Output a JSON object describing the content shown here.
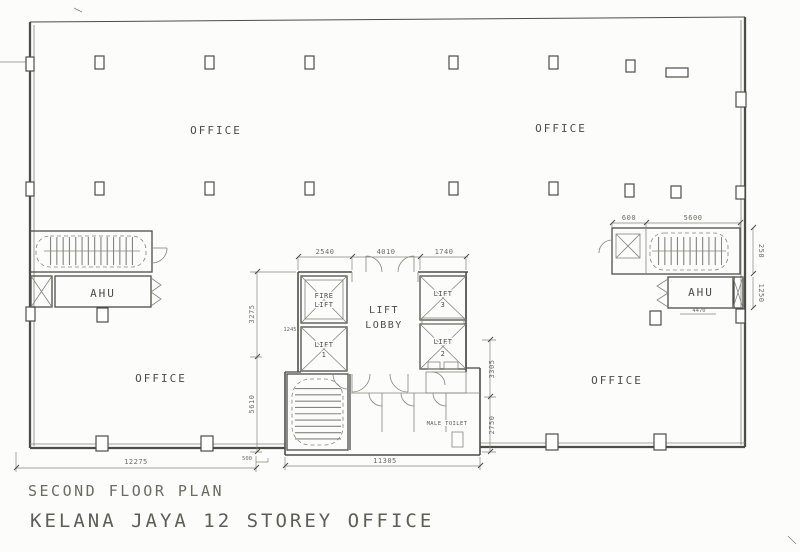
{
  "title_block": {
    "plan_title": "SECOND FLOOR PLAN",
    "project_title": "KELANA JAYA 12 STOREY OFFICE"
  },
  "labels": {
    "office": "OFFICE",
    "ahu": "AHU",
    "lift": "LIFT",
    "lobby": "LOBBY",
    "fire": "FIRE",
    "no1": "1",
    "no2": "2",
    "no3": "3",
    "male_toilet": "MALE TOILET"
  },
  "dimensions": {
    "core_width_left": "2540",
    "core_width_mid": "4010",
    "core_width_right": "1740",
    "core_height_upper": "3275",
    "core_height_lower": "5610",
    "core_right_upper": "3305",
    "core_right_lower": "2750",
    "right_stair_offset": "600",
    "right_stair_width": "5600",
    "right_edge_stair": "250",
    "right_edge_ahu": "1250",
    "right_ahu_width": "4470",
    "lift1_width": "1245",
    "left_wing_width": "12275",
    "core_bottom_offset": "500",
    "core_bottom_width": "11305"
  },
  "colors": {
    "ink": "#4c4c48",
    "ink2": "#85857e",
    "paper": "#fcfcfa"
  }
}
